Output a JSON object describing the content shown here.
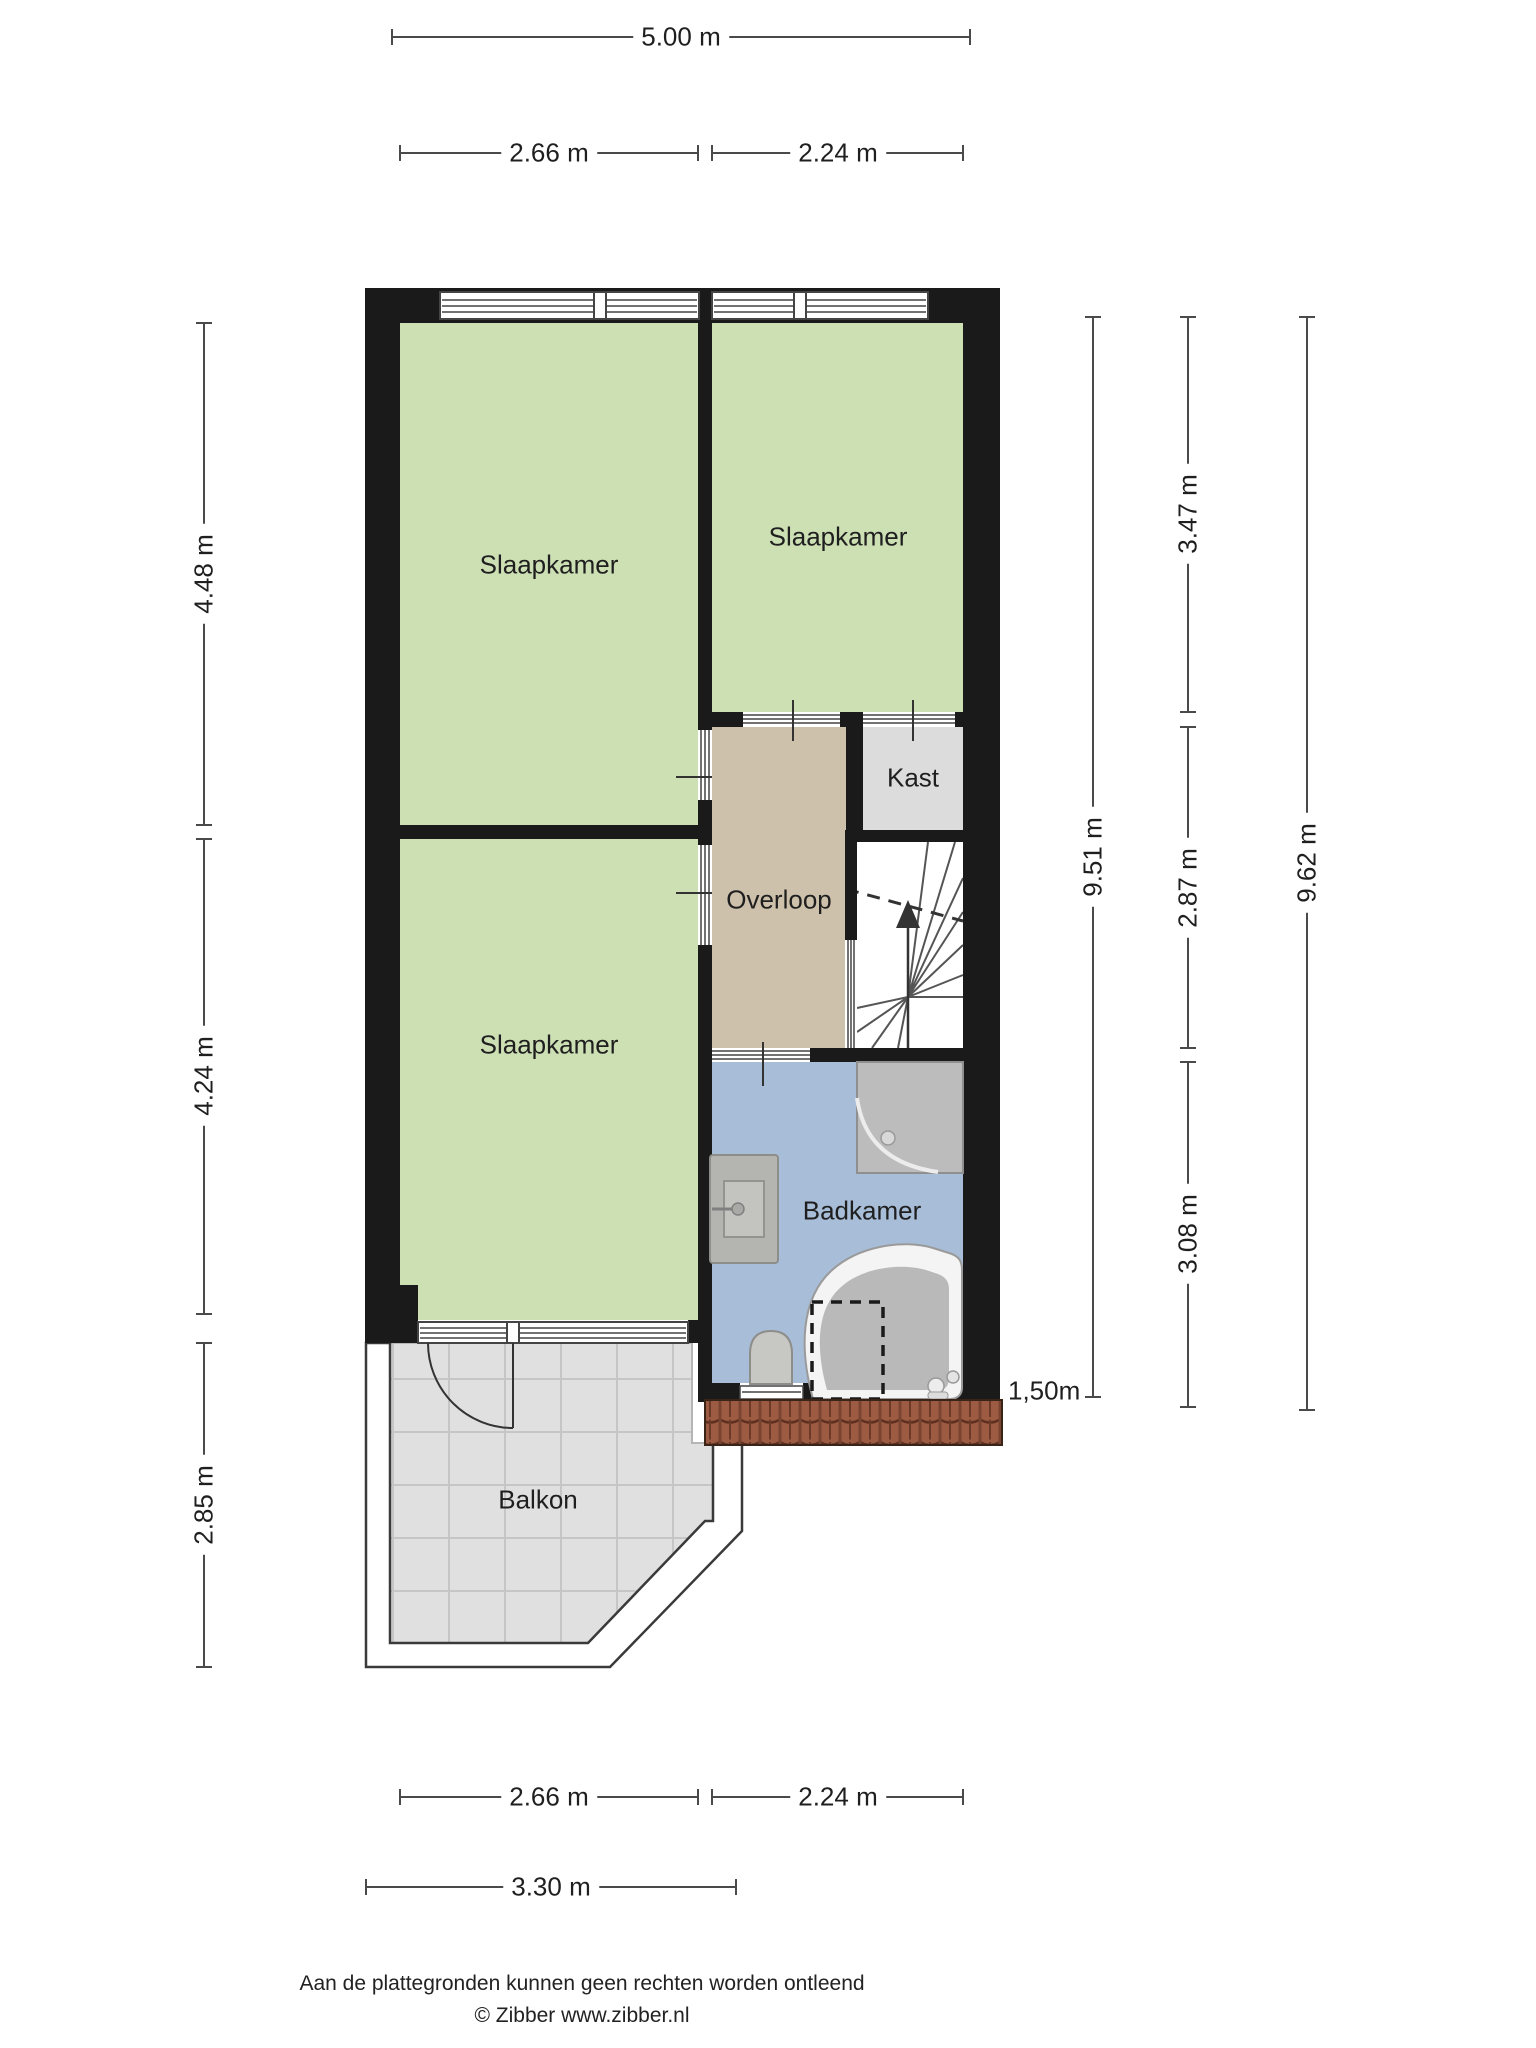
{
  "labels": {
    "room_bedroom_nw": "Slaapkamer",
    "room_bedroom_ne": "Slaapkamer",
    "room_bedroom_sw": "Slaapkamer",
    "room_closet": "Kast",
    "room_landing": "Overloop",
    "room_bathroom": "Badkamer",
    "room_balcony": "Balkon"
  },
  "dimensions": {
    "top_total": "5.00 m",
    "top_left": "2.66 m",
    "top_right": "2.24 m",
    "left_upper": "4.48 m",
    "left_middle": "4.24 m",
    "left_lower": "2.85 m",
    "right_inner_total": "9.51 m",
    "right_upper": "3.47 m",
    "right_middle": "2.87 m",
    "right_lower": "3.08 m",
    "right_outer_total": "9.62 m",
    "headroom": "1,50m",
    "bottom_left": "2.66 m",
    "bottom_right": "2.24 m",
    "bottom_balcony": "3.30 m"
  },
  "footer": {
    "disclaimer": "Aan de plattegronden kunnen geen rechten worden ontleend",
    "credit": "© Zibber www.zibber.nl"
  },
  "colors": {
    "wall": "#1a1a1a",
    "bedroom_green": "#cde0b4",
    "landing_tan": "#cec1ac",
    "bathroom_blue": "#a8bdd8",
    "closet_gray": "#dcdcdc",
    "balcony_tile_gray": "#e0e0e0",
    "roof_tile_brown": "#9c5b42",
    "fixture_gray": "#bcbcbc",
    "dimension_line": "#4a4a4a",
    "text": "#1f1f1f"
  }
}
